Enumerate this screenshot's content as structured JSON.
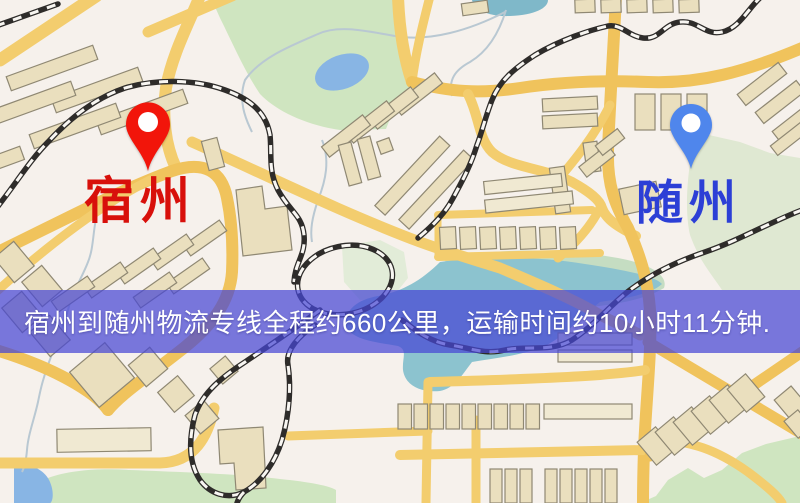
{
  "banner": {
    "text": "宿州到随州物流专线全程约660公里，运输时间约10小时11分钟.",
    "bg_color": "#4646d4",
    "text_color": "#ffffff"
  },
  "markers": {
    "origin": {
      "name": "宿州",
      "pin_color": "#f2150a",
      "label_color": "#d8100b"
    },
    "destination": {
      "name": "随州",
      "pin_color": "#4f86ec",
      "label_color": "#2c3fd6"
    }
  },
  "route_info": {
    "distance_km": "660",
    "duration": "10小时11分钟"
  },
  "map_palette": {
    "base": "#f6f1ec",
    "road": "#f3cd6e",
    "park": "#cfe5c0",
    "park_pale": "#dfe8d2",
    "pond": "#88b5e4",
    "lake": "#8cc3cf",
    "building": "#eadfbe",
    "building_outline": "#8f8873",
    "railway": "#2e2c2a",
    "stream": "#b9c8d2"
  }
}
